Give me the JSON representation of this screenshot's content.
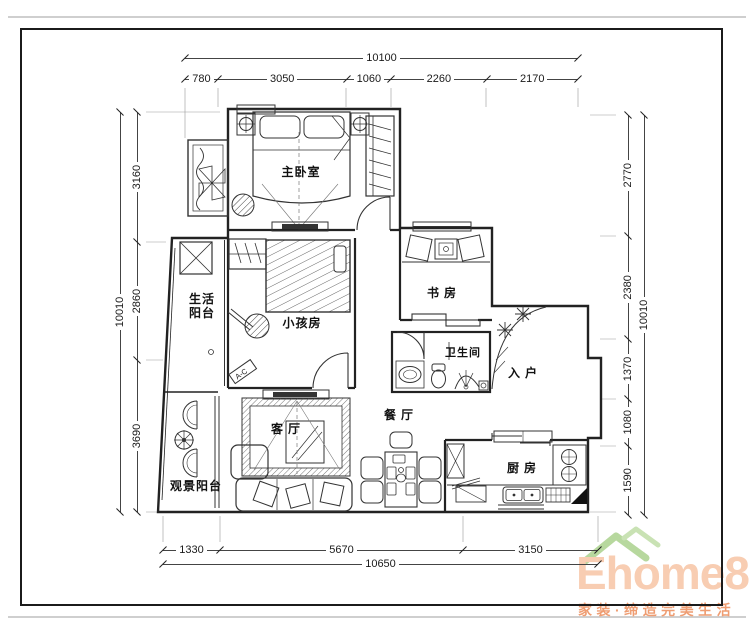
{
  "page": {
    "background": "#ffffff",
    "frame_color": "#1b1b1b",
    "line_color": "#222222"
  },
  "rooms": {
    "master_bedroom": {
      "label": "主卧室"
    },
    "living_balcony": {
      "label": "生活阳台"
    },
    "kids_room": {
      "label": "小孩房"
    },
    "study": {
      "label": "书房"
    },
    "bathroom": {
      "label": "卫生间"
    },
    "entrance": {
      "label": "入户"
    },
    "dining_room": {
      "label": "餐厅"
    },
    "living_room": {
      "label": "客厅"
    },
    "view_balcony": {
      "label": "观景阳台"
    },
    "kitchen": {
      "label": "厨房"
    },
    "ac_unit": {
      "label": "A-C"
    }
  },
  "dimensions": {
    "top": {
      "total": "10100",
      "segments": [
        "780",
        "3050",
        "1060",
        "2260",
        "2170"
      ]
    },
    "bottom": {
      "total": "10650",
      "segments": [
        "1330",
        "5670",
        "3150"
      ]
    },
    "left": {
      "total": "10010",
      "segments": [
        "3160",
        "2860",
        "3690"
      ]
    },
    "right": {
      "total": "10010",
      "segments": [
        "2770",
        "2380",
        "1370",
        "1080",
        "1590"
      ]
    }
  },
  "watermark": {
    "brand": "Ehome8",
    "tagline": "家装·缔造完美生活",
    "brand_color": "#f8cdb2",
    "roof_color": "#b7d89e",
    "tagline_color": "#ef9d72"
  }
}
